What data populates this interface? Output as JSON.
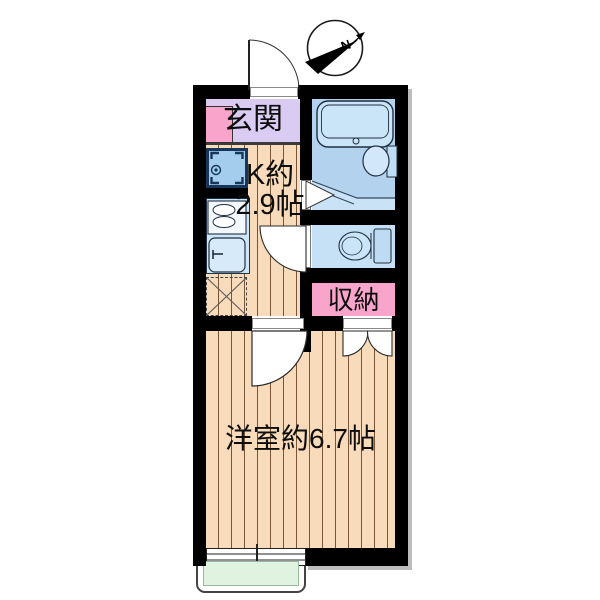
{
  "plan": {
    "type": "apartment-floor-plan",
    "compass": {
      "label": "N"
    },
    "rooms": {
      "entrance": {
        "label": "玄関"
      },
      "kitchen": {
        "label_line1": "K約",
        "label_line2": "2.9帖",
        "size_tatami": "2.9"
      },
      "storage": {
        "label": "収納"
      },
      "western_room": {
        "label": "洋室約6.7帖",
        "size_tatami": "6.7"
      }
    },
    "fixtures": [
      "bathtub",
      "bathroom-sink",
      "toilet",
      "washing-machine-pan",
      "gas-stove",
      "kitchen-sink",
      "refrigerator-space",
      "shoe-cabinet",
      "entrance-door",
      "bathroom-folding-door",
      "toilet-door",
      "room-swing-door",
      "closet-double-doors",
      "sliding-window",
      "balcony"
    ],
    "colors": {
      "wall": "#000000",
      "wood_floor": "#f8dbba",
      "wood_stripe": "#7a5535",
      "entrance_floor": "#d9cbf1",
      "accent_pink": "#f9a4cb",
      "bathroom_blue": "#c9e2f6",
      "bathroom_blue_dark": "#b3d2ee",
      "fixture_blue": "#cbe5f8",
      "kitchen_counter_blue": "#cde6f9",
      "washer_pan_blue": "#a4cded",
      "balcony_green": "#dff3e0",
      "shadow": "#bdbdbd",
      "text": "#0d0d0d"
    }
  }
}
